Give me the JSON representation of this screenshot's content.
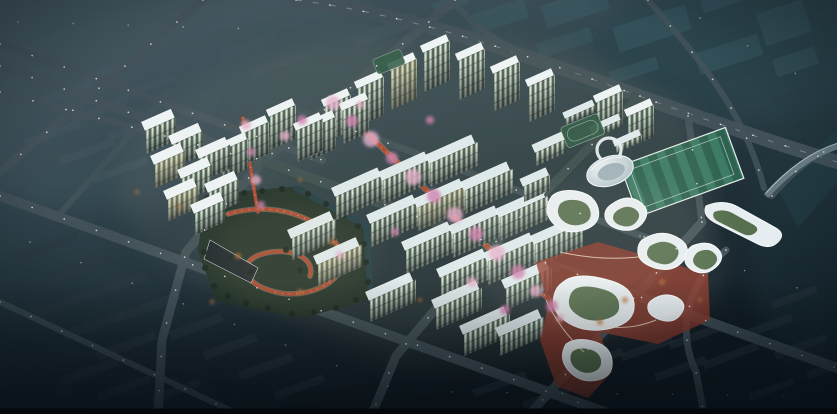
{
  "meta": {
    "scene": "nighttime-aerial-masterplan-architectural-rendering",
    "canvas": {
      "width": 837,
      "height": 414
    }
  },
  "colors": {
    "bg_top": "#45575f",
    "bg_mid": "#31454e",
    "bg_low": "#1b2931",
    "bg_bottom": "#101b22",
    "haze": "#5a6c74",
    "forest": "#2a454e",
    "plot": "#40606d",
    "block_dim": "#43565f",
    "block_dark": "#2b3942",
    "road": "#43525b",
    "lane": "#cdd9df",
    "light": "#eef6f8",
    "roof": "#dde9ed",
    "roof_bright": "#edf4f6",
    "win_lit": "#d3e5d2",
    "win_dark": "#4f5f58",
    "warm": "#d8b878",
    "pink1": "#e5aecb",
    "pink2": "#cf7fae",
    "red_path": "#a8492f",
    "plaza_red": "#8c392b",
    "park_green": "#223329",
    "tree_green": "#18251e",
    "autumn_orange": "#b96f35",
    "water": "#224049",
    "field_green": "#2d6150",
    "field_stripe": "#3b7a64",
    "white_bldg": "#e7eef1",
    "white_edge": "#f7fbfc",
    "glow_warm": "#ffe9c4",
    "bridge": "#6d818b",
    "letterbox": "#05090c"
  },
  "scene": {
    "bg_blocks": [
      [
        150,
        16,
        62,
        8,
        -20,
        "dim"
      ],
      [
        184,
        34,
        62,
        8,
        -20,
        "dim"
      ],
      [
        218,
        52,
        62,
        8,
        -20,
        "dim"
      ],
      [
        252,
        70,
        62,
        8,
        -20,
        "dim"
      ],
      [
        14,
        40,
        62,
        8,
        -20,
        "dim"
      ],
      [
        48,
        58,
        62,
        8,
        -20,
        "dim"
      ],
      [
        82,
        76,
        62,
        8,
        -20,
        "dim"
      ],
      [
        116,
        94,
        62,
        8,
        -20,
        "dim"
      ],
      [
        4,
        80,
        58,
        8,
        -20,
        "dim"
      ],
      [
        38,
        98,
        58,
        8,
        -20,
        "dim"
      ],
      [
        72,
        116,
        58,
        8,
        -20,
        "dim"
      ],
      [
        106,
        134,
        58,
        8,
        -20,
        "dim"
      ],
      [
        24,
        140,
        58,
        8,
        -20,
        "dim"
      ],
      [
        58,
        158,
        58,
        8,
        -20,
        "dim"
      ],
      [
        92,
        176,
        58,
        8,
        -20,
        "dim"
      ],
      [
        240,
        10,
        50,
        7,
        -20,
        "dim"
      ],
      [
        280,
        24,
        50,
        7,
        -20,
        "dim"
      ],
      [
        352,
        36,
        66,
        13,
        -20,
        "dim"
      ],
      [
        14,
        254,
        66,
        9,
        -20,
        "dark"
      ],
      [
        48,
        274,
        66,
        9,
        -20,
        "dark"
      ],
      [
        82,
        294,
        66,
        9,
        -20,
        "dark"
      ],
      [
        116,
        314,
        66,
        9,
        -20,
        "dark"
      ],
      [
        28,
        312,
        62,
        9,
        -20,
        "dark"
      ],
      [
        62,
        332,
        62,
        9,
        -20,
        "dark"
      ],
      [
        96,
        352,
        62,
        9,
        -20,
        "dark"
      ],
      [
        58,
        378,
        62,
        9,
        -20,
        "dark"
      ],
      [
        96,
        394,
        56,
        8,
        -20,
        "dark"
      ],
      [
        150,
        396,
        52,
        8,
        -20,
        "dark"
      ],
      [
        168,
        332,
        56,
        9,
        -20,
        "dark"
      ],
      [
        202,
        352,
        56,
        9,
        -20,
        "dark"
      ],
      [
        238,
        372,
        56,
        9,
        -20,
        "dark"
      ],
      [
        274,
        392,
        52,
        8,
        -20,
        "dark"
      ],
      [
        208,
        300,
        40,
        8,
        -20,
        "dark"
      ],
      [
        600,
        302,
        58,
        8,
        -20,
        "dark"
      ],
      [
        634,
        322,
        58,
        8,
        -20,
        "dark"
      ],
      [
        668,
        342,
        58,
        8,
        -20,
        "dark"
      ],
      [
        702,
        362,
        58,
        8,
        -20,
        "dark"
      ],
      [
        620,
        354,
        54,
        8,
        -20,
        "dark"
      ],
      [
        654,
        374,
        54,
        8,
        -20,
        "dark"
      ],
      [
        740,
        332,
        54,
        8,
        -20,
        "dark"
      ],
      [
        774,
        352,
        54,
        8,
        -20,
        "dark"
      ],
      [
        806,
        372,
        50,
        8,
        -20,
        "dark"
      ],
      [
        748,
        394,
        48,
        7,
        -20,
        "dark"
      ],
      [
        770,
        302,
        48,
        8,
        -20,
        "dark"
      ],
      [
        576,
        364,
        48,
        8,
        -20,
        "dark"
      ],
      [
        472,
        390,
        56,
        8,
        -20,
        "dark"
      ],
      [
        522,
        402,
        50,
        7,
        -20,
        "dark"
      ],
      [
        468,
        16,
        58,
        20,
        -18,
        "plot"
      ],
      [
        540,
        6,
        66,
        24,
        -18,
        "plot"
      ],
      [
        612,
        28,
        76,
        26,
        -18,
        "plot"
      ],
      [
        694,
        54,
        66,
        22,
        -18,
        "plot"
      ],
      [
        536,
        44,
        56,
        15,
        -18,
        "plot"
      ],
      [
        608,
        72,
        50,
        13,
        -18,
        "plot"
      ],
      [
        756,
        14,
        48,
        34,
        -18,
        "plot"
      ],
      [
        700,
        0,
        40,
        14,
        -18,
        "plot"
      ],
      [
        432,
        4,
        36,
        11,
        -18,
        "plot"
      ],
      [
        772,
        60,
        44,
        18,
        -18,
        "plot"
      ]
    ],
    "roads": [
      {
        "d": "M 0,44 L 322,160",
        "w": 8,
        "lit": 1
      },
      {
        "d": "M 0,66 L 837,368",
        "w": 10,
        "lit": 1
      },
      {
        "d": "M 0,92 L 262,162",
        "w": 7,
        "lit": 1
      },
      {
        "d": "M 0,196 L 610,414",
        "w": 10,
        "lit": 1
      },
      {
        "d": "M 0,302 L 238,414",
        "w": 6,
        "lit": 1,
        "op": 0.85
      },
      {
        "d": "M 203,0 L 0,172",
        "w": 8,
        "lit": 1
      },
      {
        "d": "M 168,92 L 58,216",
        "w": 6,
        "op": 0.9
      },
      {
        "d": "M 455,0 L 262,162 L 186,252 L 162,340 L 158,414",
        "w": 9,
        "lit": 1
      },
      {
        "d": "M 640,96 L 470,268 L 396,356 L 372,414",
        "w": 9,
        "lit": 1
      },
      {
        "d": "M 702,222 L 530,414",
        "w": 9,
        "lit": 1
      },
      {
        "d": "M 726,250 C 688,282 676,330 696,372 L 704,414",
        "w": 7,
        "lit": 1
      },
      {
        "d": "M 292,108 L 680,250",
        "w": 7,
        "op": 0.85,
        "lit": 1
      },
      {
        "d": "M 296,0 C 420,16 540,60 650,100 C 730,128 790,148 837,162",
        "w": 14,
        "lit": 1,
        "lane": 1
      },
      {
        "d": "M 452,0 C 478,34 520,56 566,70",
        "w": 6
      },
      {
        "d": "M 688,116 L 702,222",
        "w": 7,
        "lit": 1
      },
      {
        "d": "M 648,0 C 700,60 744,110 764,188",
        "w": 6,
        "op": 0.85,
        "lit": 1
      },
      {
        "d": "M 772,196 Q 804,158 837,146",
        "w": 6,
        "lit": 1,
        "op": 0.9
      }
    ],
    "buildings": [
      [
        325,
        106,
        26,
        36,
        7,
        "t",
        0
      ],
      [
        358,
        88,
        26,
        38,
        7,
        "t",
        0
      ],
      [
        391,
        70,
        26,
        40,
        7,
        "t",
        1
      ],
      [
        424,
        52,
        26,
        40,
        7,
        "t",
        0
      ],
      [
        459,
        60,
        26,
        40,
        7,
        "t",
        0
      ],
      [
        494,
        73,
        26,
        38,
        7,
        "t",
        0
      ],
      [
        529,
        86,
        26,
        36,
        7,
        "t",
        0
      ],
      [
        597,
        102,
        26,
        34,
        7,
        "t",
        0
      ],
      [
        628,
        116,
        26,
        32,
        7,
        "t",
        0
      ],
      [
        310,
        128,
        26,
        32,
        7,
        "t",
        0
      ],
      [
        343,
        110,
        26,
        34,
        7,
        "t",
        0
      ],
      [
        243,
        133,
        26,
        32,
        7,
        "t",
        0
      ],
      [
        270,
        116,
        26,
        34,
        7,
        "t",
        0
      ],
      [
        297,
        130,
        26,
        32,
        7,
        "t",
        0
      ],
      [
        222,
        150,
        26,
        30,
        7,
        "t",
        0
      ],
      [
        146,
        130,
        30,
        24,
        9,
        "t",
        0
      ],
      [
        173,
        144,
        30,
        24,
        9,
        "t",
        0
      ],
      [
        200,
        158,
        30,
        24,
        9,
        "t",
        0
      ],
      [
        155,
        164,
        30,
        24,
        9,
        "t",
        1
      ],
      [
        182,
        178,
        30,
        24,
        9,
        "t",
        0
      ],
      [
        209,
        192,
        30,
        24,
        9,
        "t",
        0
      ],
      [
        168,
        199,
        30,
        22,
        9,
        "t",
        1
      ],
      [
        195,
        213,
        30,
        22,
        9,
        "t",
        0
      ],
      [
        336,
        196,
        48,
        24,
        9,
        "s",
        0
      ],
      [
        371,
        223,
        48,
        24,
        9,
        "s",
        0
      ],
      [
        406,
        250,
        48,
        24,
        9,
        "s",
        0
      ],
      [
        441,
        277,
        48,
        24,
        9,
        "s",
        0
      ],
      [
        383,
        180,
        48,
        24,
        9,
        "s",
        0
      ],
      [
        418,
        207,
        48,
        24,
        9,
        "s",
        1
      ],
      [
        453,
        234,
        48,
        24,
        9,
        "s",
        0
      ],
      [
        488,
        261,
        48,
        24,
        9,
        "s",
        0
      ],
      [
        430,
        163,
        48,
        24,
        9,
        "s",
        0
      ],
      [
        465,
        190,
        48,
        24,
        9,
        "s",
        0
      ],
      [
        500,
        217,
        48,
        24,
        9,
        "s",
        0
      ],
      [
        535,
        244,
        48,
        24,
        9,
        "s",
        0
      ],
      [
        370,
        300,
        46,
        22,
        9,
        "s",
        0
      ],
      [
        436,
        308,
        46,
        22,
        9,
        "s",
        0
      ],
      [
        464,
        334,
        46,
        22,
        9,
        "s",
        0
      ],
      [
        506,
        288,
        46,
        22,
        9,
        "s",
        0
      ],
      [
        500,
        336,
        44,
        20,
        9,
        "s",
        0
      ],
      [
        292,
        238,
        44,
        22,
        9,
        "s",
        0
      ],
      [
        318,
        264,
        44,
        22,
        9,
        "s",
        1
      ],
      [
        566,
        118,
        30,
        7,
        6,
        "s",
        0
      ],
      [
        592,
        132,
        30,
        7,
        6,
        "s",
        0
      ],
      [
        616,
        146,
        26,
        7,
        6,
        "s",
        0
      ],
      [
        536,
        152,
        30,
        14,
        8,
        "s",
        0
      ],
      [
        524,
        186,
        26,
        16,
        8,
        "s",
        0
      ]
    ],
    "blossoms": [
      [
        333,
        103,
        7,
        0
      ],
      [
        352,
        121,
        6,
        1
      ],
      [
        371,
        139,
        8,
        0
      ],
      [
        392,
        158,
        6,
        1
      ],
      [
        413,
        177,
        8,
        0
      ],
      [
        434,
        196,
        7,
        1
      ],
      [
        455,
        215,
        8,
        0
      ],
      [
        476,
        234,
        7,
        1
      ],
      [
        497,
        253,
        8,
        0
      ],
      [
        518,
        272,
        7,
        1
      ],
      [
        536,
        291,
        6,
        0
      ],
      [
        552,
        306,
        6,
        1
      ],
      [
        246,
        125,
        5,
        0
      ],
      [
        251,
        152,
        4,
        1
      ],
      [
        256,
        180,
        5,
        0
      ],
      [
        261,
        205,
        4,
        1
      ],
      [
        302,
        120,
        5,
        1
      ],
      [
        285,
        136,
        5,
        0
      ],
      [
        472,
        282,
        5,
        0
      ],
      [
        505,
        310,
        5,
        1
      ],
      [
        560,
        318,
        4,
        0
      ],
      [
        430,
        120,
        4,
        1
      ],
      [
        360,
        105,
        4,
        0
      ],
      [
        395,
        232,
        4,
        1
      ],
      [
        340,
        255,
        4,
        0
      ]
    ],
    "autumn": [
      [
        238,
        256,
        3
      ],
      [
        300,
        292,
        3
      ],
      [
        332,
        242,
        3
      ],
      [
        625,
        300,
        3
      ],
      [
        600,
        322,
        3
      ],
      [
        662,
        282,
        3
      ],
      [
        700,
        300,
        2
      ],
      [
        212,
        302,
        2
      ],
      [
        180,
        207,
        2
      ],
      [
        137,
        192,
        2
      ],
      [
        420,
        300,
        2
      ],
      [
        300,
        180,
        2
      ]
    ],
    "park_trees": [
      [
        212,
        205
      ],
      [
        226,
        197
      ],
      [
        244,
        193
      ],
      [
        262,
        191
      ],
      [
        282,
        189
      ],
      [
        308,
        194
      ],
      [
        326,
        204
      ],
      [
        344,
        215
      ],
      [
        358,
        226
      ],
      [
        364,
        244
      ],
      [
        366,
        262
      ],
      [
        368,
        282
      ],
      [
        356,
        300
      ],
      [
        336,
        308
      ],
      [
        314,
        312
      ],
      [
        292,
        314
      ],
      [
        268,
        308
      ],
      [
        246,
        303
      ],
      [
        228,
        296
      ],
      [
        214,
        286
      ],
      [
        205,
        268
      ],
      [
        204,
        252
      ],
      [
        230,
        258
      ],
      [
        250,
        272
      ],
      [
        286,
        250
      ],
      [
        320,
        262
      ],
      [
        300,
        270
      ]
    ],
    "extra_lights": [
      "M 30,242 L 392,388",
      "M 452,392 L 830,396",
      "M 640,236 L 834,300",
      "M 18,22 L 292,30",
      "M 700,18 L 834,96"
    ]
  }
}
